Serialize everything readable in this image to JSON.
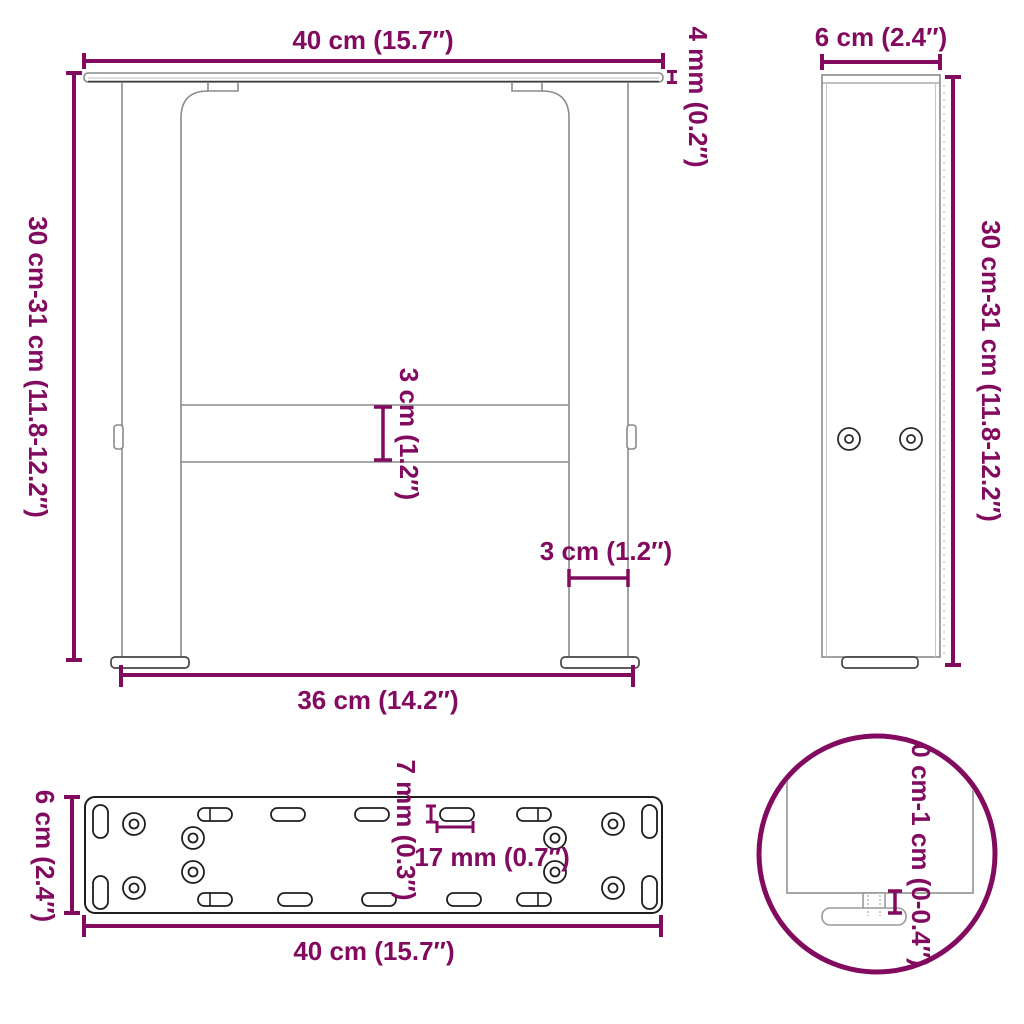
{
  "diagram": {
    "title": "table-leg-dimension-diagram",
    "front_view": {
      "top_width": "40 cm (15.7″)",
      "top_thickness": "4 mm (0.2″)",
      "height": "30 cm-31 cm (11.8-12.2″)",
      "crossbar_height": "3 cm (1.2″)",
      "leg_width": "3 cm (1.2″)",
      "bottom_width": "36 cm (14.2″)"
    },
    "side_view": {
      "depth": "6 cm (2.4″)",
      "height": "30 cm-31 cm (11.8-12.2″)"
    },
    "plate_view": {
      "slot_width": "7 mm (0.3″)",
      "slot_spacing": "17 mm (0.7″)",
      "depth": "6 cm (2.4″)",
      "width": "40 cm (15.7″)"
    },
    "detail_view": {
      "adjustment_range": "0 cm-1 cm (0-0.4″)"
    },
    "colors": {
      "dimension_accent": "#820A5F",
      "outline_gray": "#8A8A8A",
      "outline_dark": "#1E1E1E",
      "background": "#FFFFFF"
    }
  }
}
